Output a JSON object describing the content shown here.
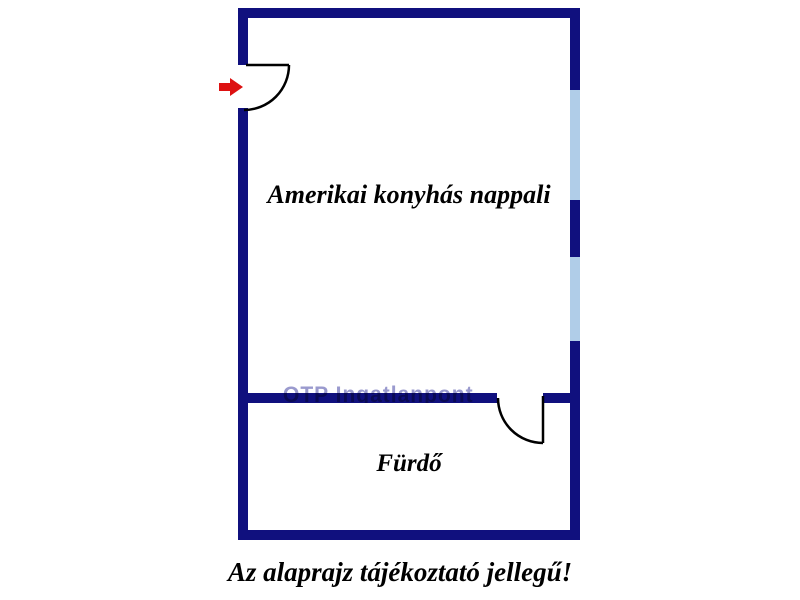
{
  "floorplan": {
    "rooms": [
      {
        "id": "living",
        "label": "Amerikai konyhás nappali"
      },
      {
        "id": "bathroom",
        "label": "Fürdő"
      }
    ],
    "caption": "Az alaprajz tájékoztató jellegű!",
    "watermark": "OTP Ingatlanpont",
    "colors": {
      "wall": "#10107e",
      "window": "#b0cde8",
      "arrow": "#dd1111",
      "door": "#000000"
    }
  }
}
